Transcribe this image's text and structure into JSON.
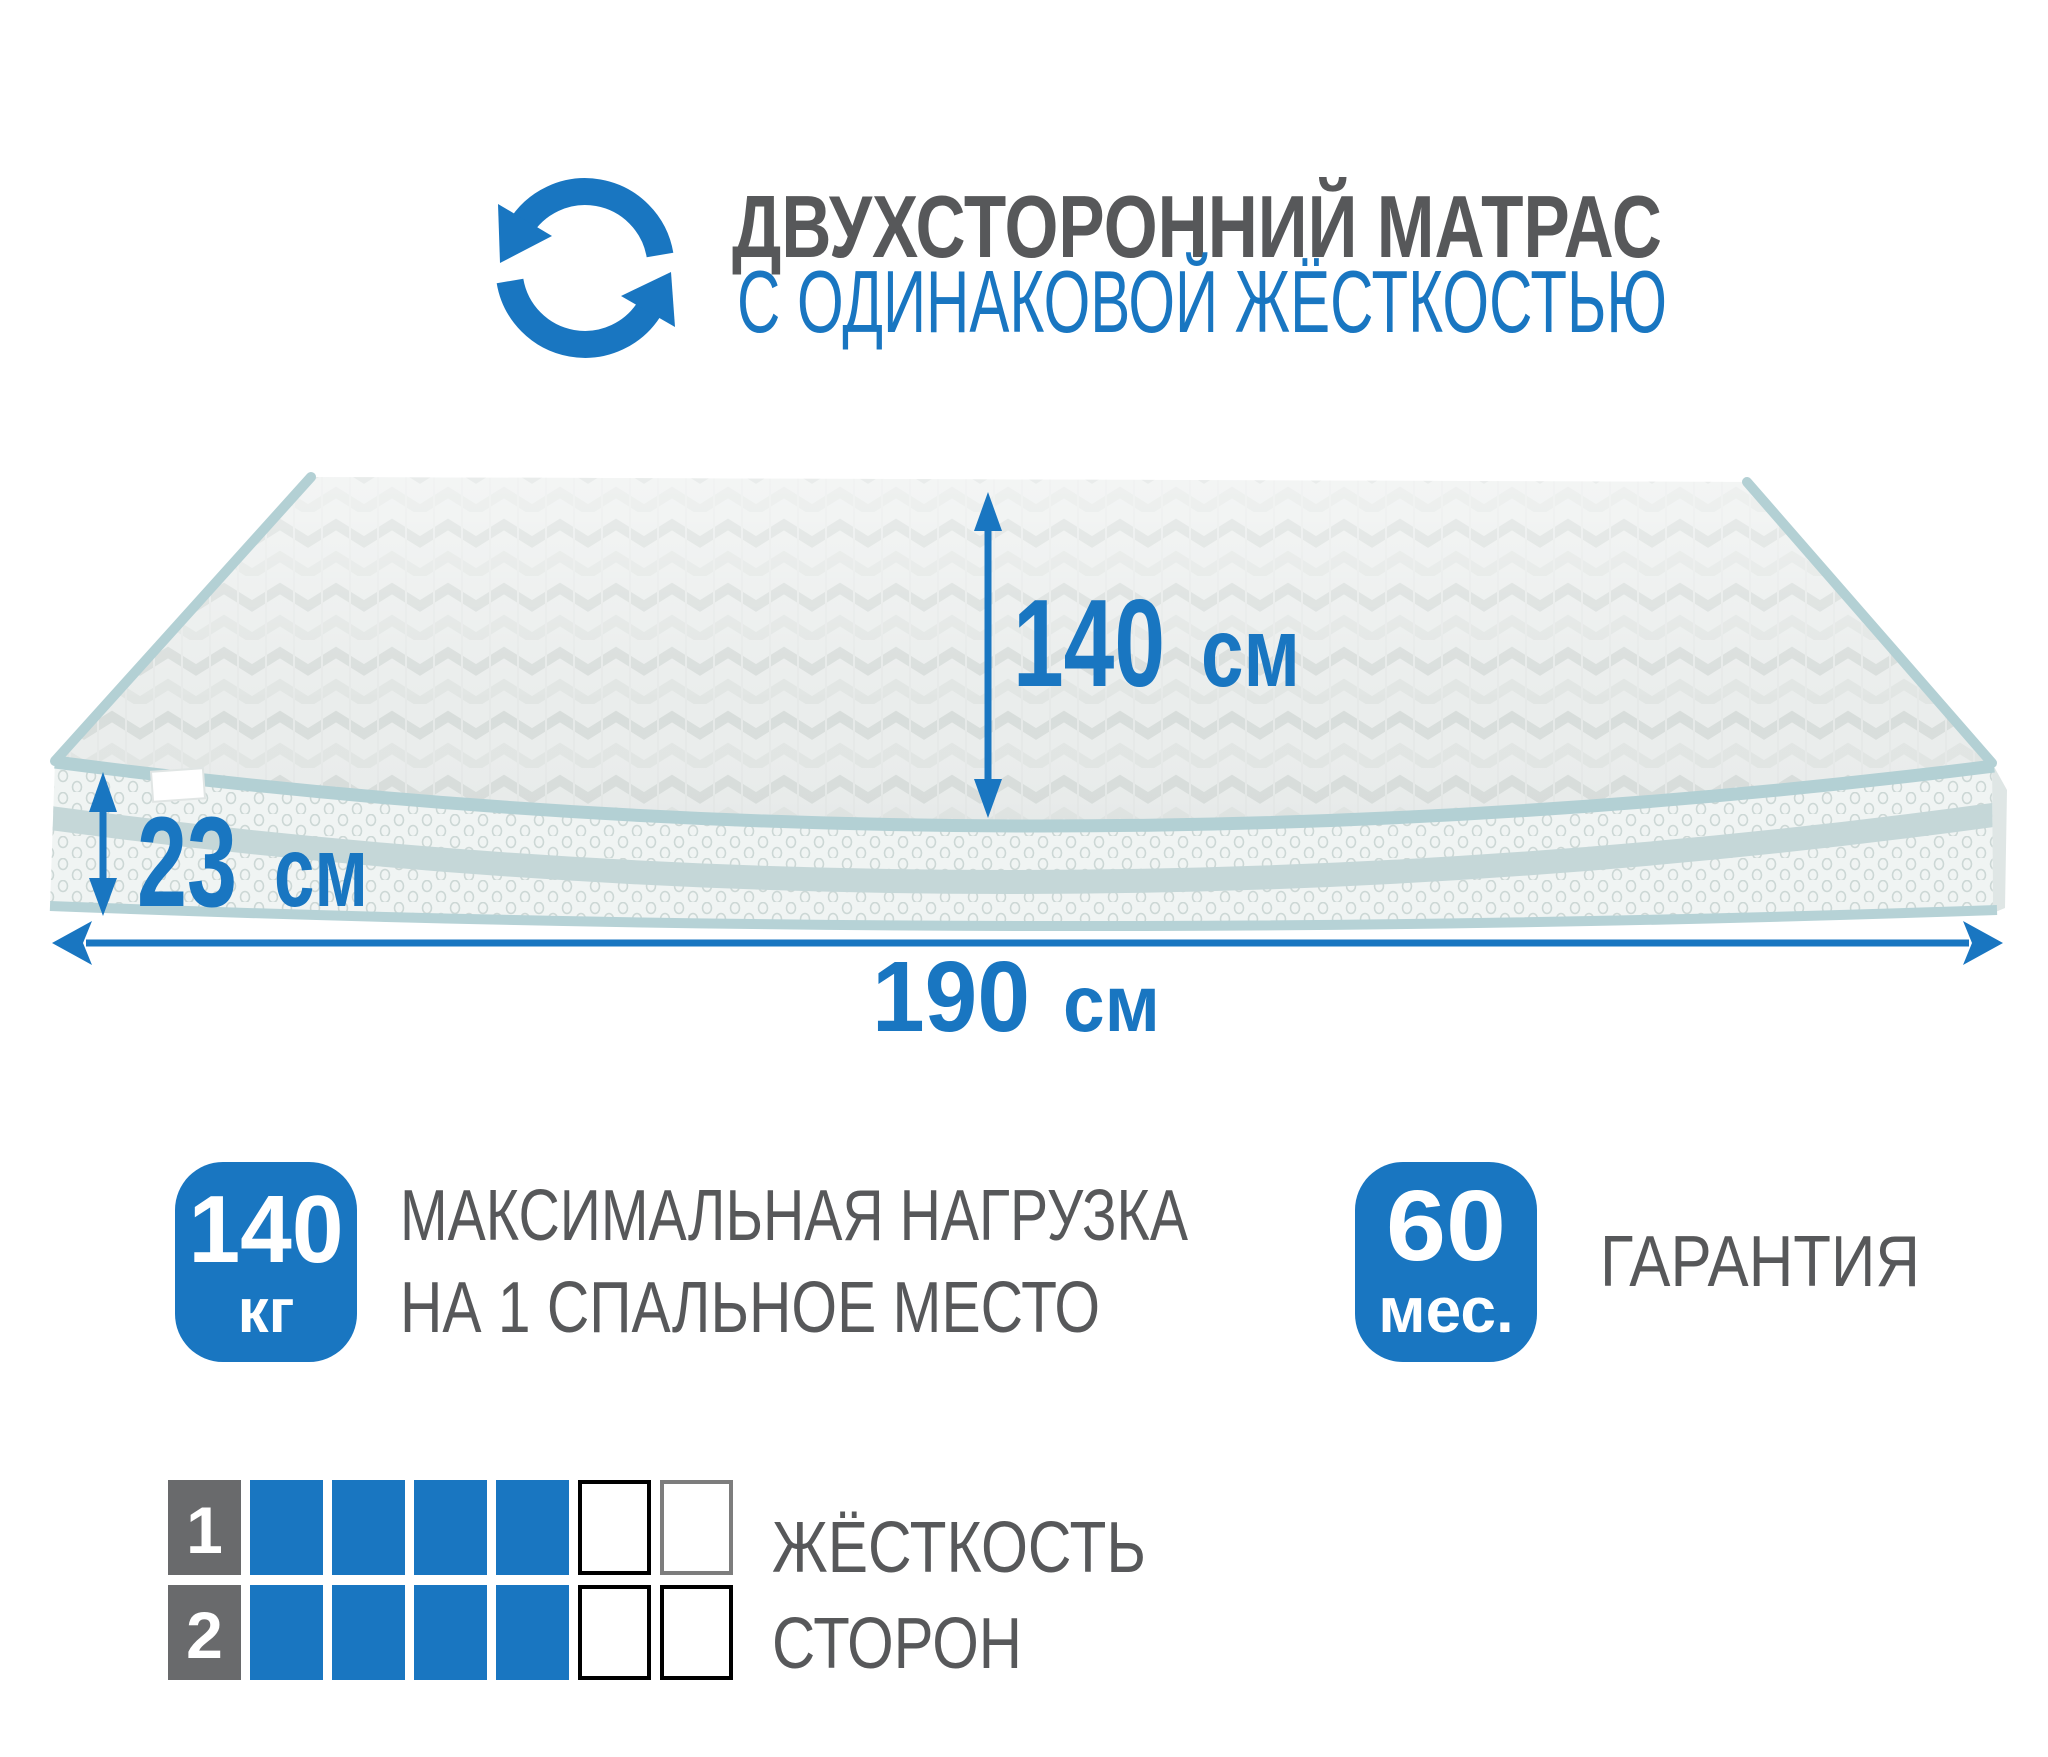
{
  "header": {
    "title_line1": "ДВУХСТОРОННИЙ МАТРАС",
    "title_line2": "С ОДИНАКОВОЙ ЖЁСТКОСТЬЮ"
  },
  "dimensions": {
    "surface_width": {
      "value": "140",
      "unit": "см"
    },
    "thickness": {
      "value": "23",
      "unit": "см"
    },
    "length": {
      "value": "190",
      "unit": "см"
    }
  },
  "badges": {
    "max_load": {
      "value": "140",
      "unit": "кг",
      "label_line1": "МАКСИМАЛЬНАЯ НАГРУЗКА",
      "label_line2": "НА 1 СПАЛЬНОЕ МЕСТО"
    },
    "warranty": {
      "value": "60",
      "unit": "мес.",
      "label": "ГАРАНТИЯ"
    }
  },
  "firmness": {
    "label_line1": "ЖЁСТКОСТЬ",
    "label_line2": "СТОРОН",
    "rows": [
      {
        "label": "1",
        "filled": 4,
        "total": 6,
        "empty_borders": [
          "#000000",
          "#7d7d7d"
        ]
      },
      {
        "label": "2",
        "filled": 4,
        "total": 6,
        "empty_borders": [
          "#000000",
          "#000000"
        ]
      }
    ]
  },
  "colors": {
    "accent_blue": "#1976c1",
    "text_gray": "#57585a",
    "label_square_gray": "#696a6c",
    "piping_teal": "#b3d0d4",
    "side_stripe": "#c5d7d8",
    "top_fabric": "#eaedec",
    "side_fabric": "#f0f4f3"
  }
}
